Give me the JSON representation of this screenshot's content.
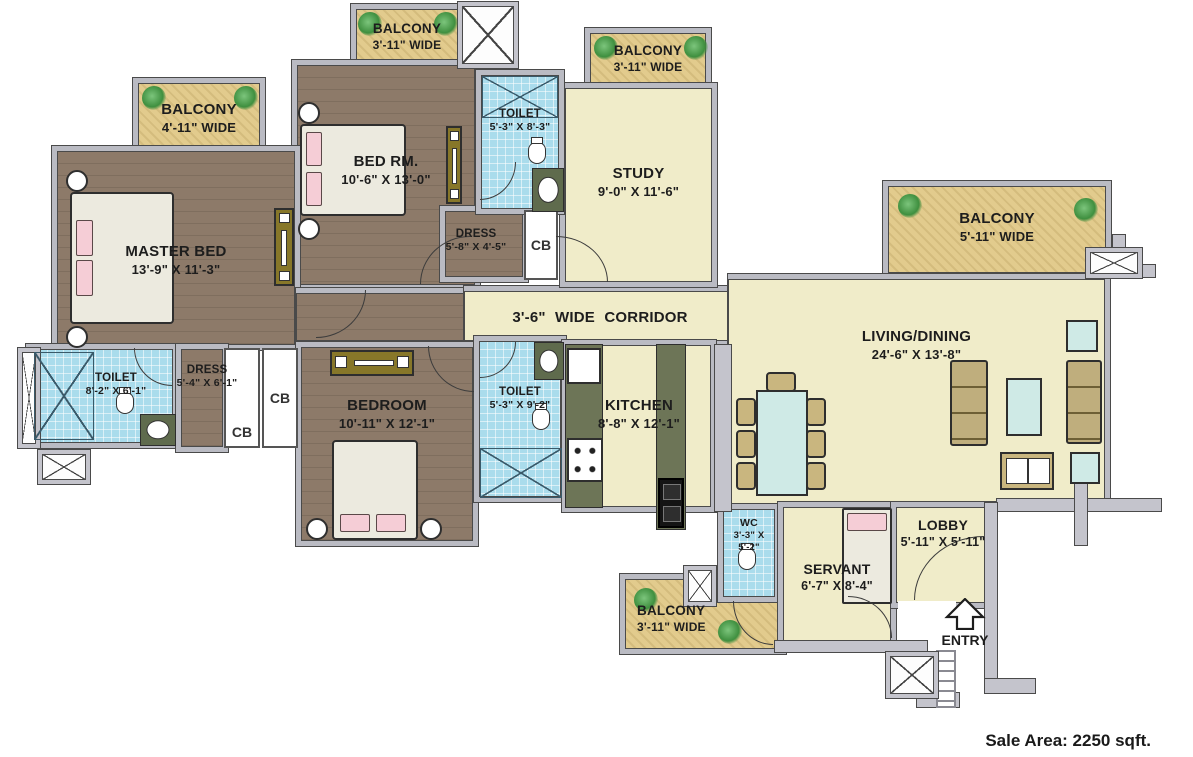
{
  "palette": {
    "wall": "#babbc3",
    "wood_floor": "#8d7a69",
    "cream_floor": "#f0ecc9",
    "balcony_floor": "#e2cb8d",
    "toilet_tile": "#aadcec",
    "kitchen_counter": "#6d7557",
    "table_teal": "#cfeae6",
    "pillow_pink": "#f5cdd6"
  },
  "rooms": {
    "master_bed": {
      "name": "MASTER BED",
      "dims": "13'-9\" X 11'-3\""
    },
    "bed_rm": {
      "name": "BED RM.",
      "dims": "10'-6\" X 13'-0\""
    },
    "bedroom": {
      "name": "BEDROOM",
      "dims": "10'-11\" X 12'-1\""
    },
    "study": {
      "name": "STUDY",
      "dims": "9'-0\" X 11'-6\""
    },
    "living_dining": {
      "name": "LIVING/DINING",
      "dims": "24'-6\" X 13'-8\""
    },
    "kitchen": {
      "name": "KITCHEN",
      "dims": "8'-8\" X 12'-1\""
    },
    "corridor": {
      "name": "3'-6\" WIDE  CORRIDOR"
    },
    "toilet_top": {
      "name": "TOILET",
      "dims": "5'-3\" X 8'-3\""
    },
    "toilet_left": {
      "name": "TOILET",
      "dims": "8'-2\" X 6'-1\""
    },
    "toilet_mid": {
      "name": "TOILET",
      "dims": "5'-3\" X 9'-2\""
    },
    "wc": {
      "name": "WC",
      "dims": "3'-3\" X 5'-2\""
    },
    "dress_top": {
      "name": "DRESS",
      "dims": "5'-8\" X 4'-5\""
    },
    "dress_left": {
      "name": "DRESS",
      "dims": "5'-4\" X 6'-1\""
    },
    "servant": {
      "name": "SERVANT",
      "dims": "6'-7\" X 8'-4\""
    },
    "lobby": {
      "name": "LOBBY",
      "dims": "5'-11\" X 5'-11\""
    },
    "balcony_master": {
      "name": "BALCONY",
      "dims": "4'-11\" WIDE"
    },
    "balcony_bedrm": {
      "name": "BALCONY",
      "dims": "3'-11\" WIDE"
    },
    "balcony_study": {
      "name": "BALCONY",
      "dims": "3'-11\" WIDE"
    },
    "balcony_right": {
      "name": "BALCONY",
      "dims": "5'-11\" WIDE"
    },
    "balcony_bottom": {
      "name": "BALCONY",
      "dims": "3'-11\" WIDE"
    }
  },
  "closets": {
    "cb1": "CB",
    "cb2": "CB",
    "cb3": "CB"
  },
  "entry": {
    "label": "ENTRY"
  },
  "footer": {
    "sale_area": "Sale Area: 2250 sqft."
  }
}
